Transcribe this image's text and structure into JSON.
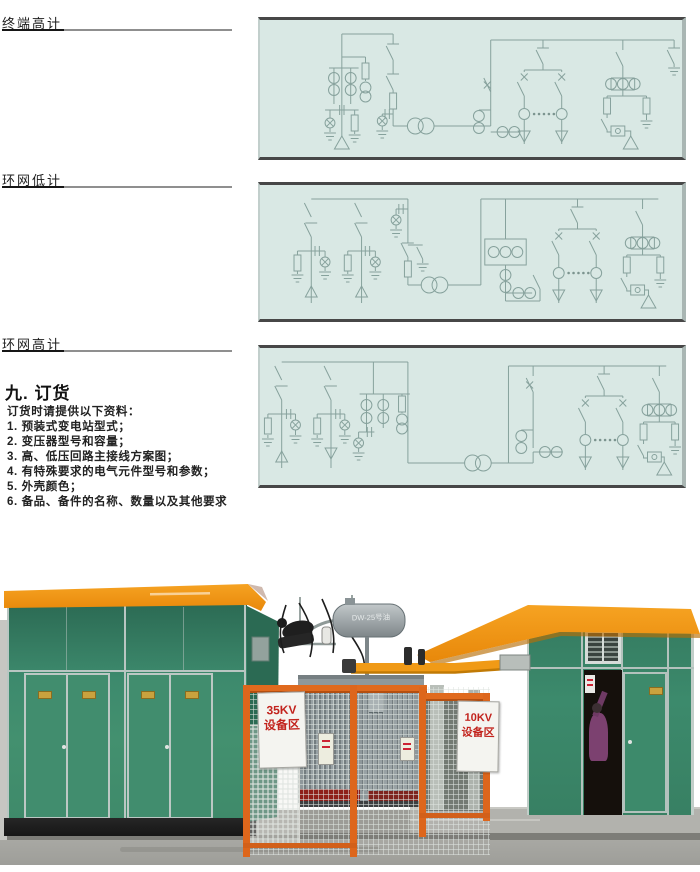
{
  "sections": [
    {
      "label": "终端高计"
    },
    {
      "label": "环网低计"
    },
    {
      "label": "环网高计"
    }
  ],
  "ordering": {
    "heading": "九. 订货",
    "intro": "订货时请提供以下资料：",
    "items": [
      "1. 预装式变电站型式；",
      "2. 变压器型号和容量；",
      "3. 高、低压回路主接线方案图；",
      "4. 有特殊要求的电气元件型号和参数；",
      "5. 外壳颜色；",
      "6. 备品、备件的名称、数量以及其他要求"
    ]
  },
  "photo": {
    "left_sign": {
      "line1": "35KV",
      "line2": "设备区"
    },
    "right_sign": {
      "line1": "10KV",
      "line2": "设备区"
    },
    "conservator_text": "DW-25号油"
  },
  "colors": {
    "diagram_bg": "#d9e8e4",
    "diagram_line": "#86a19c",
    "building_green": "#3e8b70",
    "roof_orange": "#f0930e",
    "fence_orange": "#e06a1e",
    "sign_red": "#c2231d",
    "concrete_gray": "#a3a39e"
  }
}
